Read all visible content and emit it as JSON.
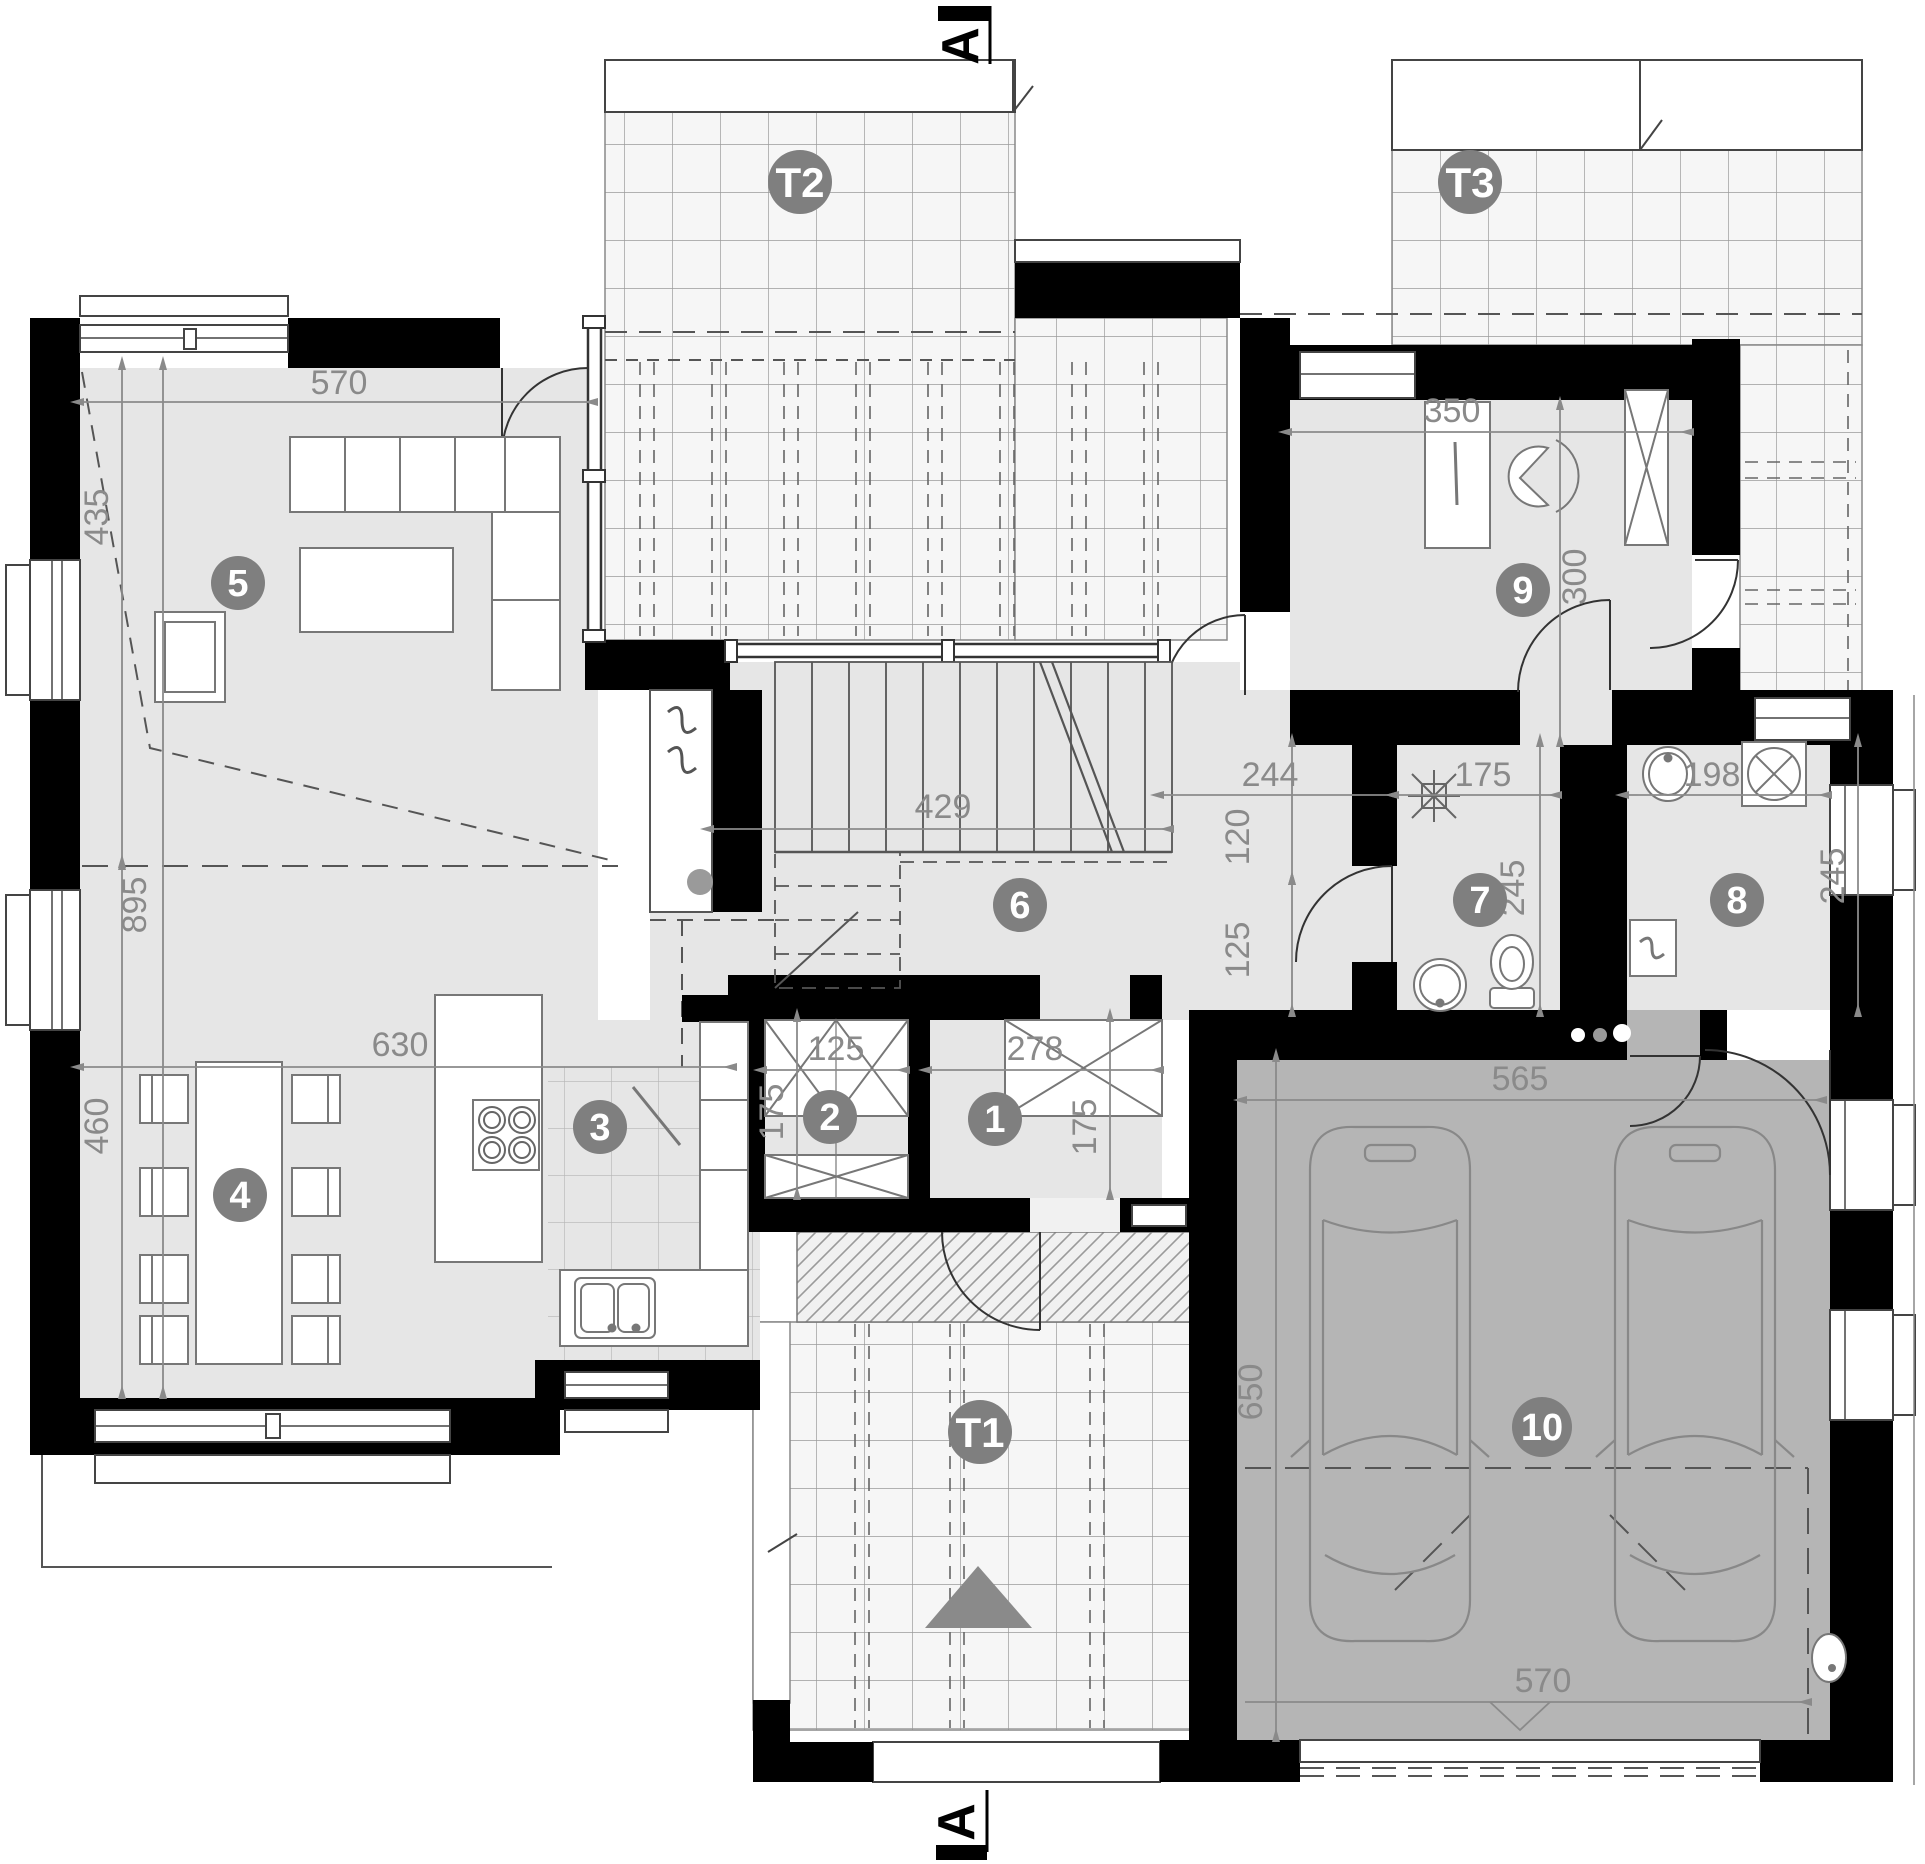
{
  "drawing": {
    "type": "architectural-floor-plan",
    "floor": "ground-floor"
  },
  "section_markers": {
    "top": "A",
    "bottom": "A"
  },
  "terraces": [
    {
      "label": "T1"
    },
    {
      "label": "T2"
    },
    {
      "label": "T3"
    }
  ],
  "rooms": [
    {
      "number": "1"
    },
    {
      "number": "2"
    },
    {
      "number": "3"
    },
    {
      "number": "4"
    },
    {
      "number": "5"
    },
    {
      "number": "6"
    },
    {
      "number": "7"
    },
    {
      "number": "8"
    },
    {
      "number": "9"
    },
    {
      "number": "10"
    }
  ],
  "dimensions": [
    {
      "value": "570"
    },
    {
      "value": "435"
    },
    {
      "value": "895"
    },
    {
      "value": "460"
    },
    {
      "value": "630"
    },
    {
      "value": "429"
    },
    {
      "value": "244"
    },
    {
      "value": "120"
    },
    {
      "value": "125"
    },
    {
      "value": "125"
    },
    {
      "value": "175"
    },
    {
      "value": "278"
    },
    {
      "value": "175"
    },
    {
      "value": "350"
    },
    {
      "value": "300"
    },
    {
      "value": "175"
    },
    {
      "value": "245"
    },
    {
      "value": "198"
    },
    {
      "value": "245"
    },
    {
      "value": "565"
    },
    {
      "value": "650"
    },
    {
      "value": "570"
    }
  ],
  "colors": {
    "wall": "#000000",
    "room_floor": "#e6e6e6",
    "garage_floor": "#b5b5b5",
    "terrace_tile": "#f6f6f6",
    "badge": "#7f7f7f",
    "dimension": "#8a8a8a"
  },
  "icons": [
    "fireplace-icon",
    "cooktop-icon",
    "kitchen-sink-icon",
    "dining-table-icon",
    "sofa-icon",
    "armchair-icon",
    "desk-icon",
    "wardrobe-x-icon",
    "stairs-icon",
    "shower-icon",
    "toilet-icon",
    "washbasin-icon",
    "washer-icon",
    "boiler-icon",
    "car-icon",
    "floor-drain-icon",
    "entrance-arrow-icon",
    "door-swing-icon"
  ]
}
